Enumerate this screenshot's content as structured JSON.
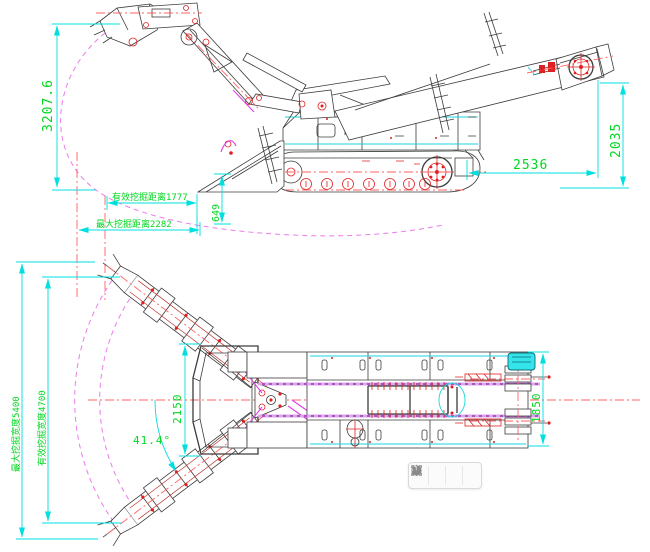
{
  "canvas": {
    "background": "#ffffff"
  },
  "colors": {
    "dimension_line": "#00dfdf",
    "dimension_text": "#00d820",
    "centerline_red": "#ff6060",
    "envelope_magenta": "#ec7bec",
    "outline": "#3c3c3c",
    "detail_red": "#e02020",
    "conveyor_band_purple": "#b050c8",
    "highlight_cyan": "#2ee6ee"
  },
  "drawing": {
    "kind": "two-view CAD engineering drawing of a crawler excavating loader (mucking machine)",
    "views": [
      "side elevation",
      "top plan"
    ]
  },
  "dims": {
    "envelope_height": "3207.6",
    "effective_digging_distance": "有效挖掘距离1777",
    "max_digging_distance": "最大挖掘距离2282",
    "shovel_lip_height": "649",
    "conveyor_overhang": "2536",
    "discharge_height": "2035",
    "max_digging_width": "最大挖掘宽度5400",
    "effective_digging_width": "有效挖掘宽度4700",
    "hopper_width": "2150",
    "machine_width": "1850",
    "swing_angle": "41.4°"
  },
  "toolbar": {
    "buttons": [
      {
        "name": "split-compare"
      },
      {
        "name": "contrast"
      },
      {
        "name": "color-sample"
      },
      {
        "name": "region-select"
      }
    ]
  }
}
